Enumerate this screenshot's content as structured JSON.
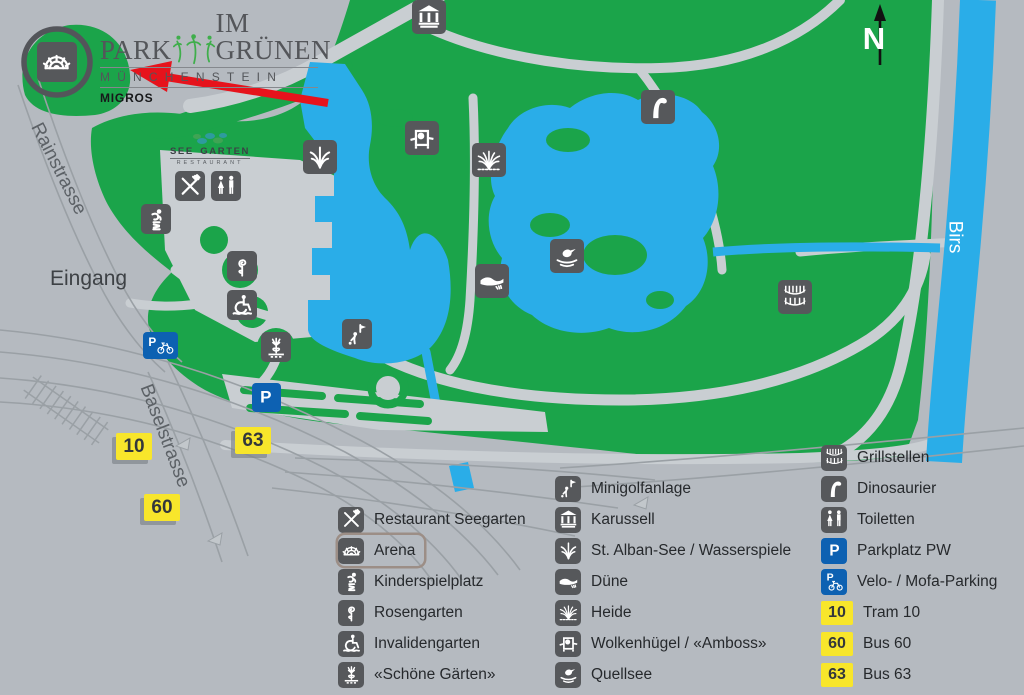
{
  "header": {
    "title_left": "PARK",
    "title_right": "IM GRÜNEN",
    "subtitle": "MÜNCHENSTEIN",
    "brand": "MIGROS"
  },
  "seegarten_logo": {
    "top_left": "SEE",
    "top_right": "GARTEN",
    "bottom": "RESTAURANT"
  },
  "labels": {
    "eingang": "Eingang",
    "rainstrasse": "Rainstrasse",
    "baselstrasse": "Baselstrasse",
    "river": "Birs",
    "north": "N"
  },
  "colors": {
    "background": "#b5bac0",
    "park_green": "#1ba44a",
    "water_blue": "#2aade8",
    "road_gray": "#c9ced2",
    "icon_dark": "#56585b",
    "parking_blue": "#0d61b2",
    "badge_yellow": "#f8e62b",
    "arrow_red": "#e6131c"
  },
  "map_badges": [
    {
      "label": "10",
      "x": 134,
      "y": 446
    },
    {
      "label": "63",
      "x": 253,
      "y": 440
    },
    {
      "label": "60",
      "x": 162,
      "y": 507
    }
  ],
  "map_icons": [
    {
      "icon": "arena",
      "x": 57,
      "y": 62,
      "size": 40,
      "style": "dark"
    },
    {
      "icon": "karussell",
      "x": 429,
      "y": 17,
      "size": 34,
      "style": "dark"
    },
    {
      "icon": "wasserspiele",
      "x": 320,
      "y": 157,
      "size": 34,
      "style": "dark"
    },
    {
      "icon": "wolkenhuegel",
      "x": 422,
      "y": 138,
      "size": 34,
      "style": "dark"
    },
    {
      "icon": "heide",
      "x": 489,
      "y": 160,
      "size": 34,
      "style": "dark"
    },
    {
      "icon": "dinosaurier",
      "x": 658,
      "y": 107,
      "size": 34,
      "style": "dark"
    },
    {
      "icon": "quellsee",
      "x": 567,
      "y": 256,
      "size": 34,
      "style": "dark"
    },
    {
      "icon": "duene",
      "x": 492,
      "y": 281,
      "size": 34,
      "style": "dark"
    },
    {
      "icon": "grillstellen",
      "x": 795,
      "y": 297,
      "size": 34,
      "style": "dark"
    },
    {
      "icon": "restaurant",
      "x": 190,
      "y": 186,
      "size": 30,
      "style": "dark"
    },
    {
      "icon": "toiletten",
      "x": 226,
      "y": 186,
      "size": 30,
      "style": "dark"
    },
    {
      "icon": "kinderspielplatz",
      "x": 156,
      "y": 219,
      "size": 30,
      "style": "dark"
    },
    {
      "icon": "rosengarten",
      "x": 242,
      "y": 266,
      "size": 30,
      "style": "dark"
    },
    {
      "icon": "invalidengarten",
      "x": 242,
      "y": 305,
      "size": 30,
      "style": "dark"
    },
    {
      "icon": "schoene-gaerten",
      "x": 276,
      "y": 347,
      "size": 30,
      "style": "dark"
    },
    {
      "icon": "minigolf",
      "x": 357,
      "y": 334,
      "size": 30,
      "style": "dark"
    },
    {
      "icon": "parkplatz",
      "x": 266,
      "y": 397,
      "size": 29,
      "style": "blue"
    },
    {
      "icon": "velo",
      "x": 160,
      "y": 345,
      "size": 27,
      "style": "blue",
      "wide": true
    }
  ],
  "legend": {
    "columns": [
      {
        "x": 338,
        "y": 504,
        "items": [
          {
            "icon": "restaurant",
            "label": "Restaurant Seegarten"
          },
          {
            "icon": "arena",
            "label": "Arena",
            "highlighted": true
          },
          {
            "icon": "kinderspielplatz",
            "label": "Kinderspielplatz"
          },
          {
            "icon": "rosengarten",
            "label": "Rosengarten"
          },
          {
            "icon": "invalidengarten",
            "label": "Invalidengarten"
          },
          {
            "icon": "schoene-gaerten",
            "label": "«Schöne Gärten»"
          }
        ]
      },
      {
        "x": 555,
        "y": 473,
        "items": [
          {
            "icon": "minigolf",
            "label": "Minigolfanlage"
          },
          {
            "icon": "karussell",
            "label": "Karussell"
          },
          {
            "icon": "wasserspiele",
            "label": "St. Alban-See / Wasserspiele"
          },
          {
            "icon": "duene",
            "label": "Düne"
          },
          {
            "icon": "heide",
            "label": "Heide"
          },
          {
            "icon": "wolkenhuegel",
            "label": "Wolkenhügel / «Amboss»"
          },
          {
            "icon": "quellsee",
            "label": "Quellsee"
          }
        ]
      },
      {
        "x": 821,
        "y": 442,
        "items": [
          {
            "icon": "grillstellen",
            "label": "Grillstellen"
          },
          {
            "icon": "dinosaurier",
            "label": "Dinosaurier"
          },
          {
            "icon": "toiletten",
            "label": "Toiletten"
          },
          {
            "icon": "parkplatz",
            "label": "Parkplatz PW",
            "style": "blue"
          },
          {
            "icon": "velo-sq",
            "label": "Velo- / Mofa-Parking",
            "style": "blue"
          },
          {
            "badge": "10",
            "label": "Tram 10"
          },
          {
            "badge": "60",
            "label": "Bus 60"
          },
          {
            "badge": "63",
            "label": "Bus 63"
          }
        ]
      }
    ]
  }
}
